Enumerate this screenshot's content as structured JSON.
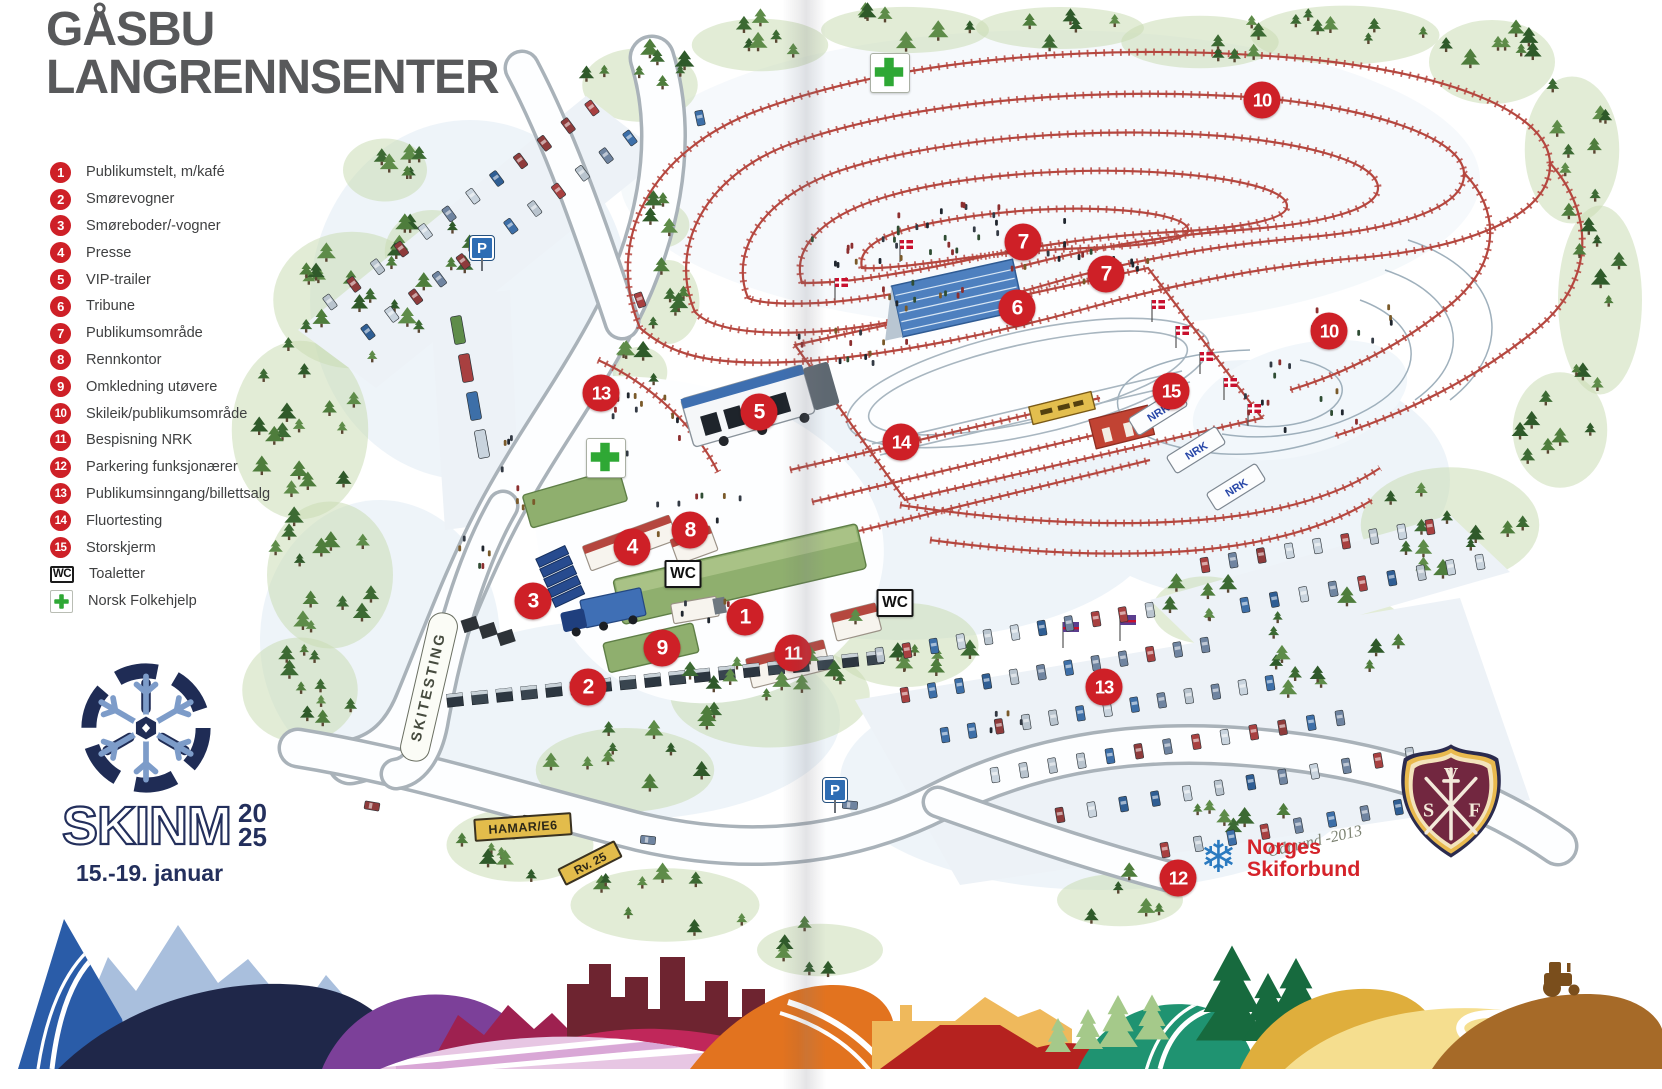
{
  "title": {
    "line1": "GÅSBU",
    "line2": "LANGRENNSENTER"
  },
  "legend": {
    "items": [
      {
        "badge": "1",
        "type": "num",
        "label": "Publikumstelt, m/kafé"
      },
      {
        "badge": "2",
        "type": "num",
        "label": "Smørevogner"
      },
      {
        "badge": "3",
        "type": "num",
        "label": "Smøreboder/-vogner"
      },
      {
        "badge": "4",
        "type": "num",
        "label": "Presse"
      },
      {
        "badge": "5",
        "type": "num",
        "label": "VIP-trailer"
      },
      {
        "badge": "6",
        "type": "num",
        "label": "Tribune"
      },
      {
        "badge": "7",
        "type": "num",
        "label": "Publikumsområde"
      },
      {
        "badge": "8",
        "type": "num",
        "label": "Rennkontor"
      },
      {
        "badge": "9",
        "type": "num",
        "label": "Omkledning utøvere"
      },
      {
        "badge": "10",
        "type": "num",
        "label": "Skileik/publikumsområde"
      },
      {
        "badge": "11",
        "type": "num",
        "label": "Bespisning NRK"
      },
      {
        "badge": "12",
        "type": "num",
        "label": "Parkering funksjonærer"
      },
      {
        "badge": "13",
        "type": "num",
        "label": "Publikumsinngang/billettsalg"
      },
      {
        "badge": "14",
        "type": "num",
        "label": "Fluortesting"
      },
      {
        "badge": "15",
        "type": "num",
        "label": "Storskjerm"
      },
      {
        "badge": "WC",
        "type": "wc",
        "label": "Toaletter"
      },
      {
        "badge": "",
        "type": "cross",
        "label": "Norsk Folkehjelp"
      }
    ]
  },
  "event": {
    "name": "SKINM",
    "year_line1": "20",
    "year_line2": "25",
    "dates": "15.-19. januar"
  },
  "logos": {
    "skiforbund": {
      "line1": "Norges",
      "line2": "Skiforbund",
      "flake": "❄"
    },
    "club_crest_letters": {
      "top": "V",
      "left": "S",
      "right": "F"
    }
  },
  "map": {
    "signature": "Odmund -2013",
    "signs": {
      "skitesting": "SKITESTING",
      "hamar": "HAMAR/E6",
      "rv25": "Rv. 25"
    },
    "symbols": {
      "parking": "P",
      "toilet": "WC",
      "nrk": "NRK"
    },
    "markers": [
      {
        "n": "1",
        "x": 745,
        "y": 617
      },
      {
        "n": "2",
        "x": 588,
        "y": 687
      },
      {
        "n": "3",
        "x": 533,
        "y": 601
      },
      {
        "n": "4",
        "x": 632,
        "y": 547
      },
      {
        "n": "5",
        "x": 759,
        "y": 412
      },
      {
        "n": "6",
        "x": 1017,
        "y": 308
      },
      {
        "n": "7",
        "x": 1023,
        "y": 242
      },
      {
        "n": "7",
        "x": 1106,
        "y": 274
      },
      {
        "n": "8",
        "x": 690,
        "y": 530
      },
      {
        "n": "9",
        "x": 662,
        "y": 648
      },
      {
        "n": "10",
        "x": 1262,
        "y": 100
      },
      {
        "n": "10",
        "x": 1329,
        "y": 331
      },
      {
        "n": "11",
        "x": 793,
        "y": 653
      },
      {
        "n": "12",
        "x": 1178,
        "y": 878
      },
      {
        "n": "13",
        "x": 601,
        "y": 393
      },
      {
        "n": "13",
        "x": 1104,
        "y": 687
      },
      {
        "n": "14",
        "x": 901,
        "y": 442
      },
      {
        "n": "15",
        "x": 1171,
        "y": 391
      }
    ],
    "wc_boxes": [
      {
        "x": 683,
        "y": 574
      },
      {
        "x": 895,
        "y": 603
      }
    ],
    "aid_crosses": [
      {
        "x": 890,
        "y": 73
      },
      {
        "x": 606,
        "y": 458
      }
    ],
    "p_signs": [
      {
        "x": 482,
        "y": 248
      },
      {
        "x": 835,
        "y": 790
      }
    ]
  },
  "colors": {
    "title_gray": "#58595B",
    "marker_red": "#CE2027",
    "navy": "#232F5C",
    "aid_green": "#2FA835",
    "nsf_red": "#D5232A",
    "nsf_blue": "#2A7AC0",
    "fence_red": "#B5473F",
    "crest_maroon": "#722740",
    "crest_gold": "#E9B94E"
  }
}
